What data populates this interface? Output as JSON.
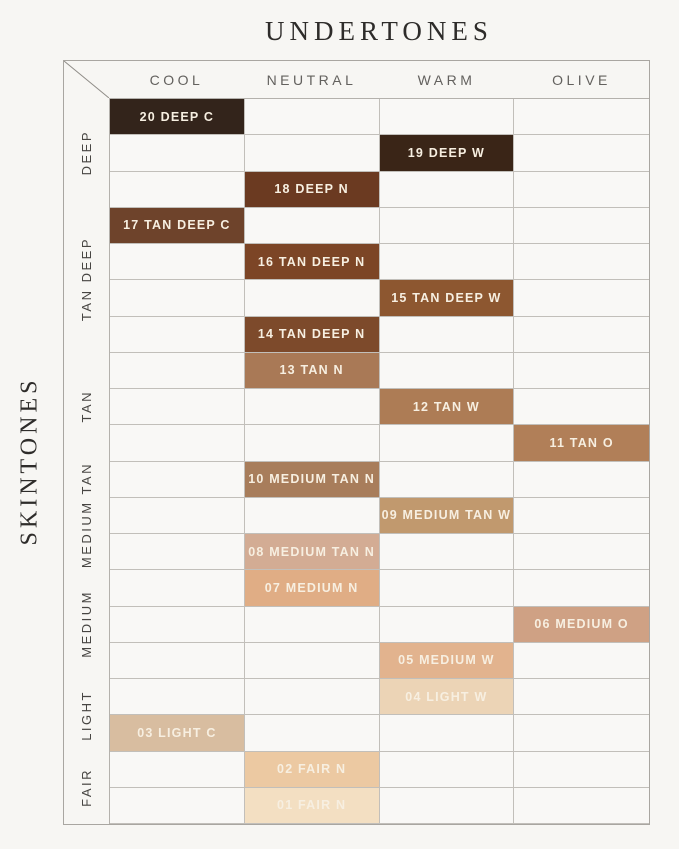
{
  "title": "UNDERTONES",
  "side_title": "SKINTONES",
  "chart_data": {
    "type": "table",
    "title": "UNDERTONES",
    "ylabel": "SKINTONES",
    "columns": [
      "COOL",
      "NEUTRAL",
      "WARM",
      "OLIVE"
    ],
    "total_rows": 20,
    "grid_on": true,
    "text_color_on_swatch": "#f7efe1",
    "row_groups": [
      {
        "label": "DEEP",
        "row_count": 3
      },
      {
        "label": "TAN DEEP",
        "row_count": 4
      },
      {
        "label": "TAN",
        "row_count": 3
      },
      {
        "label": "MEDIUM TAN",
        "row_count": 3
      },
      {
        "label": "MEDIUM",
        "row_count": 3
      },
      {
        "label": "LIGHT",
        "row_count": 2
      },
      {
        "label": "FAIR",
        "row_count": 2
      }
    ],
    "cells": [
      {
        "label": "20 DEEP C",
        "row": 1,
        "column": "COOL",
        "color": "#33241b"
      },
      {
        "label": "19 DEEP W",
        "row": 2,
        "column": "WARM",
        "color": "#3a2517"
      },
      {
        "label": "18 DEEP N",
        "row": 3,
        "column": "NEUTRAL",
        "color": "#6b3a21"
      },
      {
        "label": "17 TAN DEEP C",
        "row": 4,
        "column": "COOL",
        "color": "#6e432b"
      },
      {
        "label": "16 TAN DEEP N",
        "row": 5,
        "column": "NEUTRAL",
        "color": "#7c4526"
      },
      {
        "label": "15 TAN DEEP W",
        "row": 6,
        "column": "WARM",
        "color": "#8d5730"
      },
      {
        "label": "14 TAN DEEP N",
        "row": 7,
        "column": "NEUTRAL",
        "color": "#7d4a2b"
      },
      {
        "label": "13 TAN N",
        "row": 8,
        "column": "NEUTRAL",
        "color": "#a97956"
      },
      {
        "label": "12 TAN W",
        "row": 9,
        "column": "WARM",
        "color": "#ad7c55"
      },
      {
        "label": "11 TAN O",
        "row": 10,
        "column": "OLIVE",
        "color": "#b17f58"
      },
      {
        "label": "10 MEDIUM TAN N",
        "row": 11,
        "column": "NEUTRAL",
        "color": "#a87d5b"
      },
      {
        "label": "09 MEDIUM TAN W",
        "row": 12,
        "column": "WARM",
        "color": "#c1996e"
      },
      {
        "label": "08 MEDIUM TAN N",
        "row": 13,
        "column": "NEUTRAL",
        "color": "#d3ac94"
      },
      {
        "label": "07 MEDIUM N",
        "row": 14,
        "column": "NEUTRAL",
        "color": "#e0ad85"
      },
      {
        "label": "06 MEDIUM O",
        "row": 15,
        "column": "OLIVE",
        "color": "#cfa184"
      },
      {
        "label": "05 MEDIUM W",
        "row": 16,
        "column": "WARM",
        "color": "#e2b38e"
      },
      {
        "label": "04 LIGHT W",
        "row": 17,
        "column": "WARM",
        "color": "#ecd4b6"
      },
      {
        "label": "03 LIGHT C",
        "row": 18,
        "column": "COOL",
        "color": "#d8bda0"
      },
      {
        "label": "02 FAIR N",
        "row": 19,
        "column": "NEUTRAL",
        "color": "#ecc9a2"
      },
      {
        "label": "01 FAIR N",
        "row": 20,
        "column": "NEUTRAL",
        "color": "#f3dfc2"
      }
    ]
  }
}
